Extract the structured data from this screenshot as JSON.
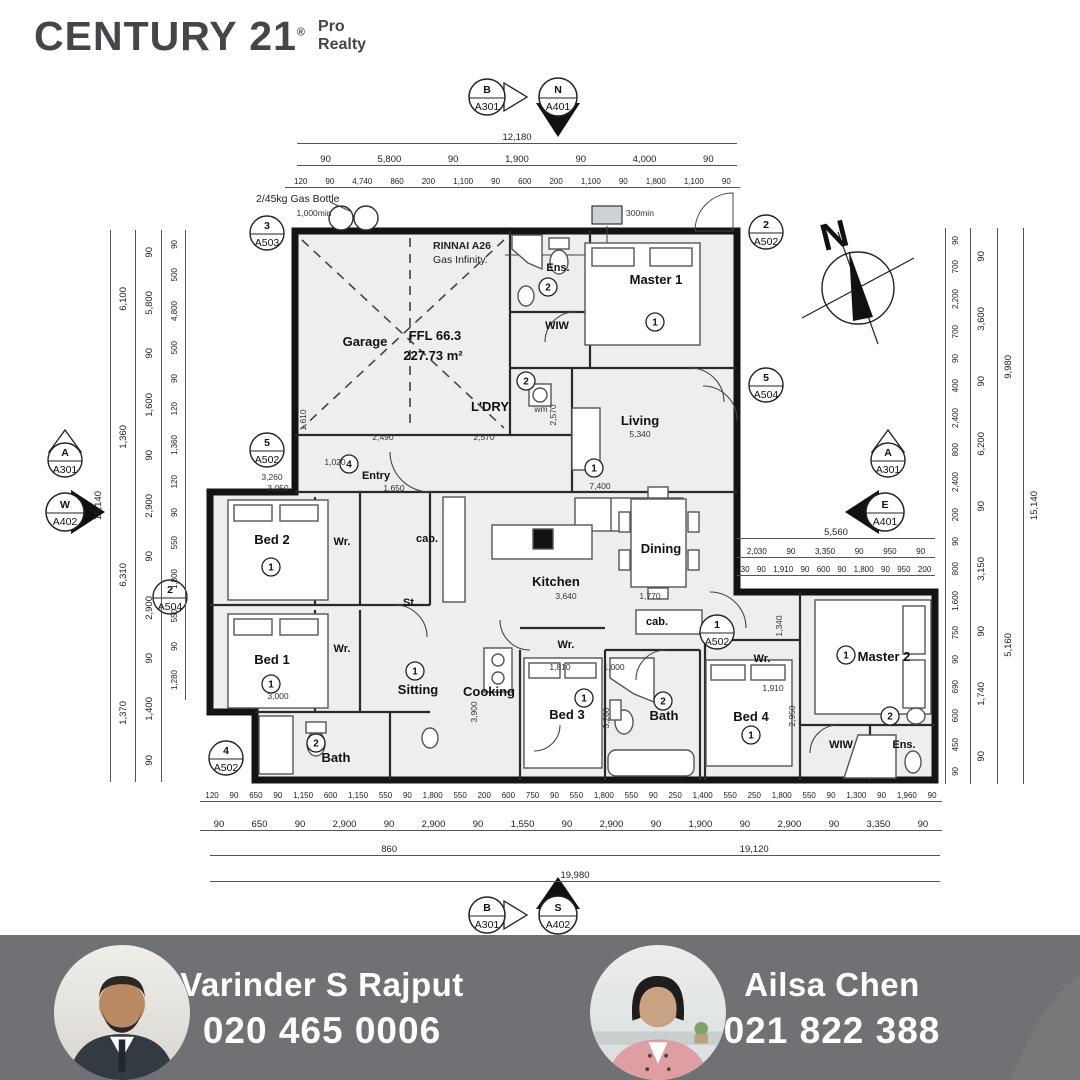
{
  "brand": {
    "century": "CENTURY 21",
    "reg": "®",
    "sub1": "Pro",
    "sub2": "Realty"
  },
  "plan": {
    "rooms": {
      "garage": "Garage",
      "ffl": "FFL 66.3",
      "area": "227.73 m²",
      "ldry": "L'DRY",
      "ens1": "Ens.",
      "wiw1": "WIW",
      "master1": "Master 1",
      "living": "Living",
      "entry": "Entry",
      "kitchen": "Kitchen",
      "dining": "Dining",
      "bed1": "Bed 1",
      "bed2": "Bed 2",
      "bed3": "Bed 3",
      "bed4": "Bed 4",
      "sitting": "Sitting",
      "cooking": "Cooking",
      "bath1": "Bath",
      "bath2": "Bath",
      "master2": "Master 2",
      "wiw2": "WIW",
      "ens2": "Ens.",
      "wr1": "Wr.",
      "wr2": "Wr.",
      "wr3": "Wr.",
      "wr4": "Wr.",
      "cab1": "cab.",
      "cab2": "cab.",
      "st": "St.",
      "wm": "wm"
    },
    "refs": {
      "one": "1",
      "two": "2",
      "four": "4"
    },
    "notes": {
      "gas": "2/45kg Gas Bottle",
      "rinnai1": "RINNAI A26",
      "rinnai2": "Gas Infinity.",
      "compass_n": "N"
    },
    "markers": {
      "top_b": {
        "label": "B",
        "sheet": "A301"
      },
      "top_n": {
        "label": "N",
        "sheet": "A401"
      },
      "g3": {
        "label": "3",
        "sheet": "A503"
      },
      "r2": {
        "label": "2",
        "sheet": "A502"
      },
      "r5": {
        "label": "5",
        "sheet": "A504"
      },
      "left_a": {
        "label": "A",
        "sheet": "A301"
      },
      "left_w": {
        "label": "W",
        "sheet": "A402"
      },
      "e5": {
        "label": "5",
        "sheet": "A502"
      },
      "b2m": {
        "label": "2",
        "sheet": "A504"
      },
      "b4m": {
        "label": "4",
        "sheet": "A502"
      },
      "right_a": {
        "label": "A",
        "sheet": "A301"
      },
      "right_e": {
        "label": "E",
        "sheet": "A401"
      },
      "w1": {
        "label": "1",
        "sheet": "A502"
      },
      "bot_b": {
        "label": "B",
        "sheet": "A301"
      },
      "bot_s": {
        "label": "S",
        "sheet": "A402"
      }
    },
    "interior": [
      "1,000min",
      "300min",
      "5,340",
      "7,400",
      "3,640",
      "1,770",
      "3,260",
      "3,050",
      "1,650",
      "3,000",
      "1,810",
      "1,000",
      "1,910",
      "2,570",
      "3,900",
      "3,260",
      "2,950",
      "1,340",
      "1,020",
      "2,490",
      "2,570",
      "1,610"
    ],
    "dims": {
      "top1": [
        "12,180"
      ],
      "top2": [
        "90",
        "5,800",
        "90",
        "1,900",
        "90",
        "4,000",
        "90"
      ],
      "top3": [
        "120",
        "90",
        "4,740",
        "860",
        "200",
        "1,100",
        "90",
        "600",
        "200",
        "1,100",
        "90",
        "1,800",
        "1,100",
        "90"
      ],
      "bottom1": [
        "120",
        "90",
        "650",
        "90",
        "1,150",
        "600",
        "1,150",
        "550",
        "90",
        "1,800",
        "550",
        "200",
        "600",
        "750",
        "90",
        "550",
        "1,800",
        "550",
        "90",
        "250",
        "1,400",
        "550",
        "250",
        "1,800",
        "550",
        "90",
        "1,300",
        "90",
        "1,960",
        "90"
      ],
      "bottom2": [
        "90",
        "650",
        "90",
        "2,900",
        "90",
        "2,900",
        "90",
        "1,550",
        "90",
        "2,900",
        "90",
        "1,900",
        "90",
        "2,900",
        "90",
        "3,350",
        "90"
      ],
      "bottom3": [
        "860",
        "19,120"
      ],
      "bottom4": [
        "19,980"
      ],
      "left1": [
        "15,140"
      ],
      "left2": [
        "6,100",
        "1,360",
        "6,310",
        "1,370"
      ],
      "left3": [
        "90",
        "5,800",
        "90",
        "1,600",
        "90",
        "2,900",
        "90",
        "2,900",
        "90",
        "1,400",
        "90"
      ],
      "left4": [
        "90",
        "500",
        "4,800",
        "500",
        "90",
        "120",
        "1,360",
        "120",
        "90",
        "550",
        "1,800",
        "550",
        "90",
        "1,280"
      ],
      "right1": [
        "90",
        "700",
        "2,200",
        "700",
        "90",
        "400",
        "2,400",
        "800",
        "2,400",
        "200",
        "90",
        "800",
        "1,600",
        "750",
        "90",
        "690",
        "600",
        "450",
        "90"
      ],
      "right2": [
        "90",
        "3,600",
        "90",
        "6,200",
        "90",
        "3,150",
        "90",
        "1,740",
        "90"
      ],
      "right3": [
        "9,980",
        "5,160"
      ],
      "right4": [
        "15,140"
      ],
      "wing1": [
        "5,560"
      ],
      "wing2": [
        "2,030",
        "90",
        "3,350",
        "90",
        "950",
        "90"
      ],
      "wing3": [
        "30",
        "90",
        "1,910",
        "90",
        "600",
        "90",
        "1,800",
        "90",
        "950",
        "200"
      ]
    }
  },
  "footer": {
    "agents": [
      {
        "name": "Varinder S Rajput",
        "phone": "020 465 0006"
      },
      {
        "name": "Ailsa Chen",
        "phone": "021 822 388"
      }
    ]
  }
}
